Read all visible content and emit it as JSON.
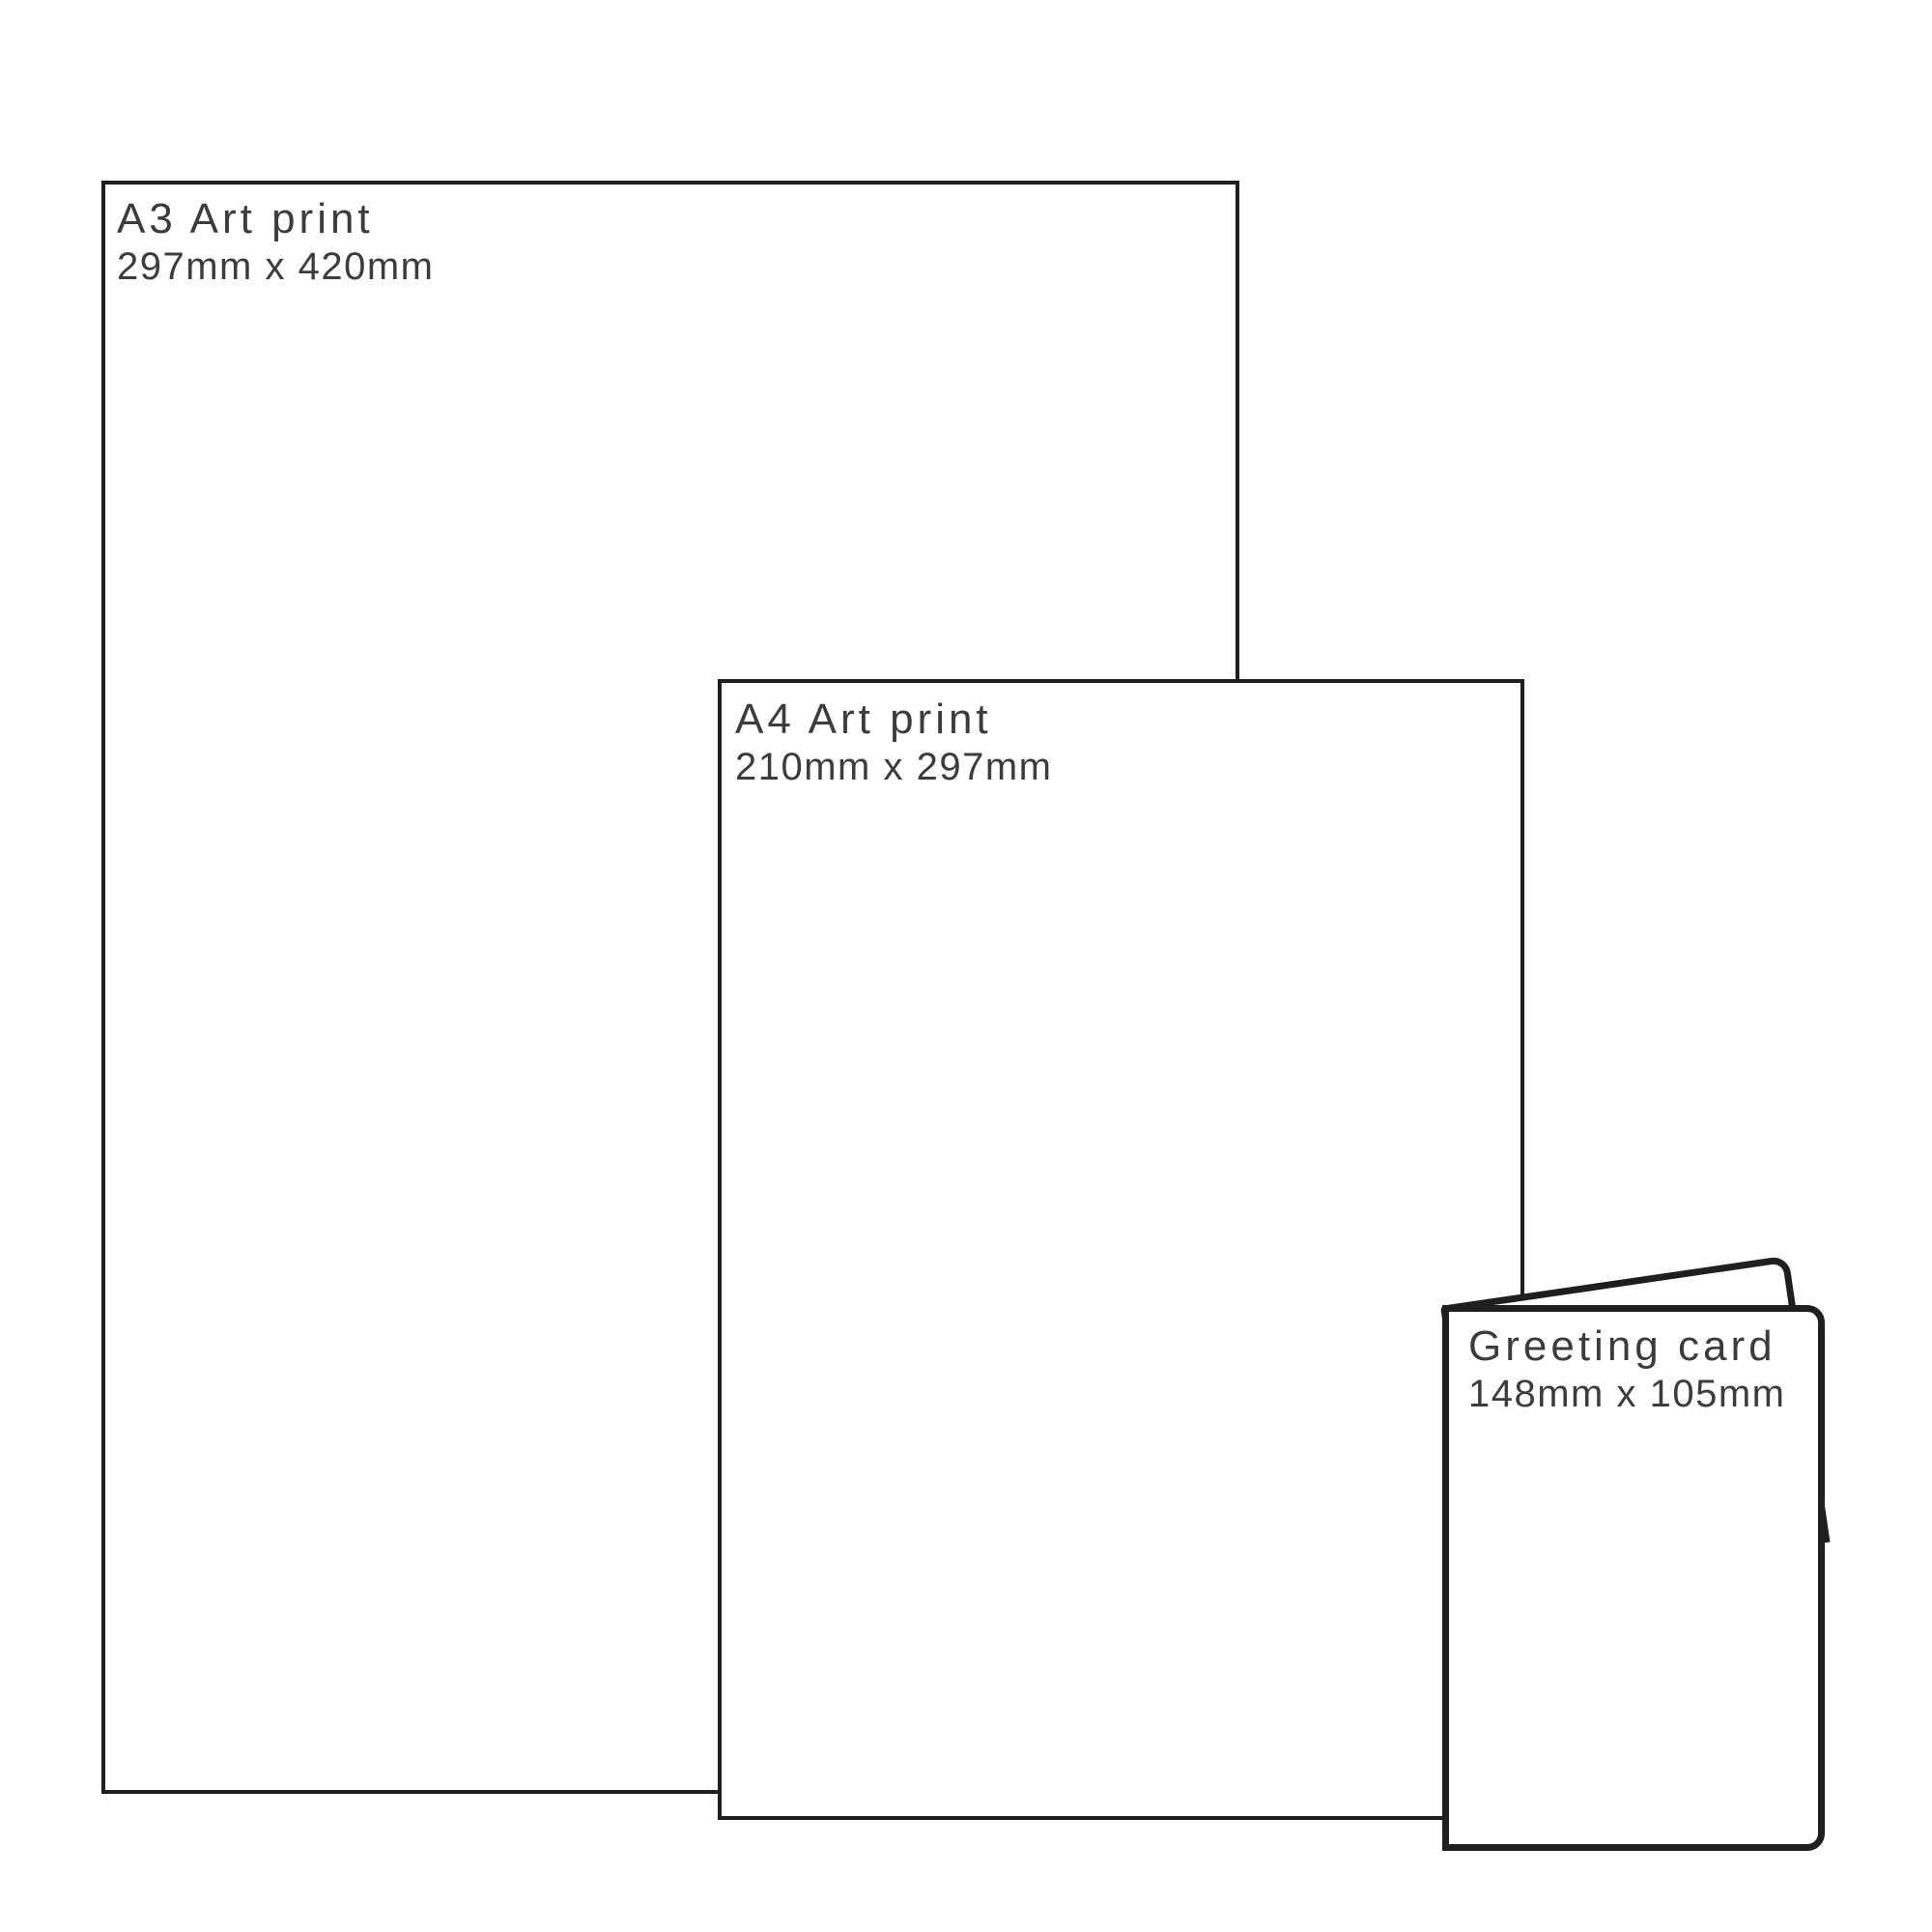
{
  "diagram": {
    "background": "#ffffff",
    "outline_color": "#1f1f1f",
    "label_color": "#3c3c3c",
    "items": [
      {
        "name": "a3-art-print",
        "title": "A3 Art print",
        "size_label": "297mm x 420mm"
      },
      {
        "name": "a4-art-print",
        "title": "A4 Art print",
        "size_label": "210mm x 297mm"
      },
      {
        "name": "greeting-card",
        "title": "Greeting card",
        "size_label": "148mm x 105mm"
      }
    ]
  }
}
